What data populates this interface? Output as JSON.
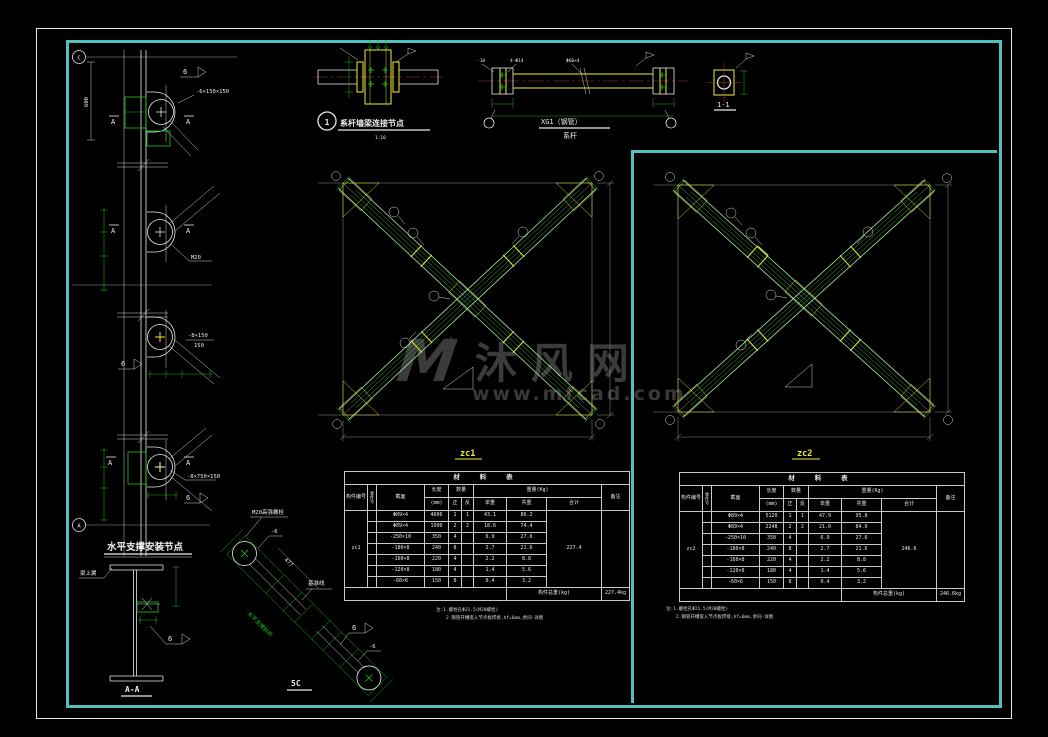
{
  "page": {
    "background": "#000000",
    "frame_outer_color": "#e6e6e6",
    "frame_inner_color": "#53bfc1"
  },
  "watermark": {
    "logo": "M",
    "star": "+",
    "brand": "沐风网",
    "url": "www.mfcad.com"
  },
  "left_detail": {
    "grid_bubble_top": "C",
    "grid_bubble_bottom": "A",
    "dim_height": "600",
    "plate_top": "-6×150×150",
    "weld_size": "6",
    "section_mark": "A",
    "bolt": "M20",
    "plate_mid_num": "-8×150",
    "plate_mid_den": "150",
    "plate_bottom": "-8×750×150",
    "title": "水平支撑安装节点"
  },
  "section_aa": {
    "flange_label": "梁上翼",
    "weld_size": "6",
    "label": "A-A"
  },
  "detail_1": {
    "bubble": "1",
    "title": "系杆墙梁连接节点",
    "scale": "1:10"
  },
  "xg1": {
    "plate_label": "-10",
    "hole_label": "4-Φ14",
    "pipe_label": "Φ60×4",
    "name": "XG1（钢管）",
    "subtitle": "系杆"
  },
  "section_11": {
    "label": "1-1"
  },
  "braces": {
    "zc1_label": "zc1",
    "zc2_label": "zc2"
  },
  "detail_5c": {
    "bolt_label": "M20高强螺栓",
    "plate_front": "-6",
    "dim": "477",
    "datum": "基准线",
    "member_note": "水平支撑斜杆",
    "weld_size": "6",
    "plate_end": "-6",
    "label": "5C"
  },
  "material_table": {
    "title": "材 料 表",
    "headers": {
      "member": "构件编号",
      "part": "零件号",
      "section": "截面",
      "length": "长度",
      "length_unit": "(mm)",
      "qty": "数量",
      "qty_pos": "正",
      "qty_neg": "反",
      "weight": "重量(Kg)",
      "unit_weight": "单重",
      "total_weight": "共重",
      "sum": "合计",
      "remark": "备注",
      "footer_label": "构件总重(kg)"
    }
  },
  "table_zc1": {
    "member": "zc1",
    "rows": [
      [
        "Φ89×4",
        "4606",
        "1",
        "1",
        "43.1",
        "86.2"
      ],
      [
        "Φ89×4",
        "1990",
        "2",
        "2",
        "18.6",
        "74.4"
      ],
      [
        "-250×10",
        "350",
        "4",
        "",
        "6.9",
        "27.6"
      ],
      [
        "-180×8",
        "240",
        "8",
        "",
        "2.7",
        "21.6"
      ],
      [
        "-160×8",
        "220",
        "4",
        "",
        "2.2",
        "8.8"
      ],
      [
        "-120×8",
        "180",
        "4",
        "",
        "1.4",
        "5.6"
      ],
      [
        "-60×6",
        "150",
        "8",
        "",
        "0.4",
        "3.2"
      ]
    ],
    "sum": "227.4",
    "total": "227.4kg",
    "notes": [
      "注:1.螺栓孔Φ21.5(M20螺栓)",
      "2.钢管开槽嵌入节点板焊接,hf=6mm,余同-详图"
    ]
  },
  "table_zc2": {
    "member": "zc2",
    "rows": [
      [
        "Φ89×4",
        "5120",
        "1",
        "1",
        "47.9",
        "95.8"
      ],
      [
        "Φ89×4",
        "2248",
        "2",
        "2",
        "21.0",
        "84.0"
      ],
      [
        "-250×10",
        "350",
        "4",
        "",
        "6.9",
        "27.6"
      ],
      [
        "-180×8",
        "240",
        "8",
        "",
        "2.7",
        "21.6"
      ],
      [
        "-160×8",
        "220",
        "4",
        "",
        "2.2",
        "8.8"
      ],
      [
        "-120×8",
        "180",
        "4",
        "",
        "1.4",
        "5.6"
      ],
      [
        "-60×6",
        "150",
        "8",
        "",
        "0.4",
        "3.2"
      ]
    ],
    "sum": "246.6",
    "total": "246.6kg",
    "notes": [
      "注:1.螺栓孔Φ21.5(M20螺栓)",
      "2.钢管开槽嵌入节点板焊接,hf=6mm,余同-详图"
    ]
  }
}
